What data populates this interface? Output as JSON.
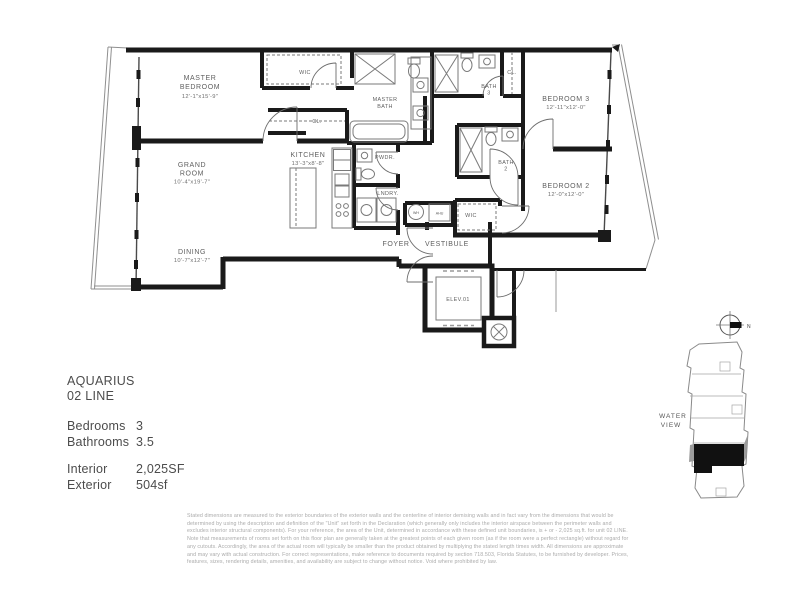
{
  "unit_info": {
    "name": "AQUARIUS",
    "line": "02 LINE",
    "bedrooms_label": "Bedrooms",
    "bedrooms_value": "3",
    "bathrooms_label": "Bathrooms",
    "bathrooms_value": "3.5",
    "interior_label": "Interior",
    "interior_value": "2,025SF",
    "exterior_label": "Exterior",
    "exterior_value": "504sf"
  },
  "rooms": {
    "master_bedroom": {
      "line1": "MASTER",
      "line2": "BEDROOM",
      "dims": "12'-1\"x15'-9\""
    },
    "grand_room": {
      "line1": "GRAND",
      "line2": "ROOM",
      "dims": "10'-4\"x19'-7\""
    },
    "dining": {
      "name": "DINING",
      "dims": "10'-7\"x12'-7\""
    },
    "kitchen": {
      "name": "KITCHEN",
      "dims": "13'-3\"x8'-8\""
    },
    "bedroom_3": {
      "name": "BEDROOM 3",
      "dims": "12'-11\"x12'-0\""
    },
    "bedroom_2": {
      "name": "BEDROOM 2",
      "dims": "12'-0\"x12'-0\""
    },
    "master_bath": {
      "line1": "MASTER",
      "line2": "BATH"
    },
    "bath_3": {
      "line1": "BATH",
      "line2": "3"
    },
    "bath_2": {
      "line1": "BATH",
      "line2": "2"
    },
    "wic_master": "WIC",
    "wic_bedroom2": "WIC",
    "closet_hall": "CL.",
    "closet_bedroom3": "CL.",
    "powder": "PWDR.",
    "laundry": "LNDRY.",
    "foyer": "FOYER",
    "vestibule": "VESTIBULE",
    "elevator": "ELEV.01",
    "water_heater": "WH",
    "air_handler": "AHU"
  },
  "keyplan": {
    "north": "N",
    "view_line1": "WATER",
    "view_line2": "VIEW"
  },
  "colors": {
    "wall": "#1a1a1a",
    "fixture": "#7a7a7a",
    "label": "#5f5f5f",
    "disclaimer_text": "#ababab"
  },
  "disclaimer": "Stated dimensions are measured to the exterior boundaries of the exterior walls and the centerline of interior demising walls and in fact vary from the dimensions that would be determined by using the description and definition of the \"Unit\" set forth in the Declaration (which generally only includes the interior airspace between the perimeter walls and excludes interior structural components). For your reference, the area of the Unit, determined in accordance with these defined unit boundaries, is + or - 2,025 sq.ft. for unit 02 LINE. Note that measurements of rooms set forth on this floor plan are generally taken at the greatest points of each given room (as if the room were a perfect rectangle) without regard for any cutouts. Accordingly, the area of the actual room will typically be smaller than the product obtained by multiplying the stated length times width. All dimensions are approximate and may vary with actual construction. For correct representations, make reference to documents required by section 718.503, Florida Statutes, to be furnished by developer. Prices, features, sizes, rendering details, amenities, and availability are subject to change without notice. Void where prohibited by law."
}
